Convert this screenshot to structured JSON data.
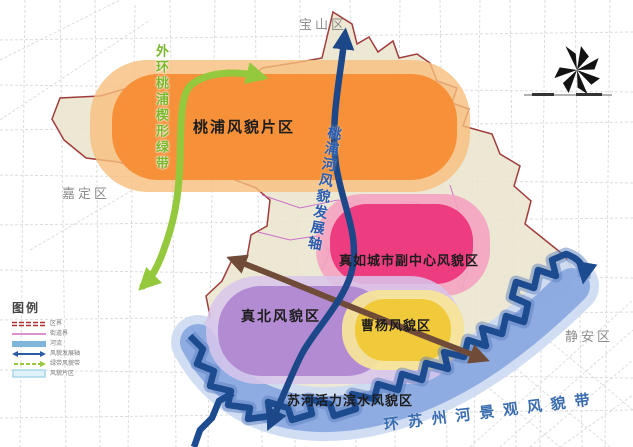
{
  "map": {
    "region_labels": {
      "baoshan": "宝山区",
      "jiading": "嘉定区",
      "jingan": "静安区"
    },
    "zones": {
      "taopu": {
        "label": "桃浦风貌片区",
        "color": "#F6913A",
        "halo": "#F7BE7C"
      },
      "zhenru": {
        "label": "真如城市副中心风貌区",
        "color": "#EE3C80",
        "halo": "#F3A3C0"
      },
      "zhenbei": {
        "label": "真北风貌区",
        "color": "#B28BD3",
        "halo": "#D8C6EB"
      },
      "caoyang": {
        "label": "曹杨风貌区",
        "color": "#F1CA3C",
        "halo": "#F6E49A"
      },
      "suhe": {
        "label": "苏河活力滨水风貌区",
        "color": "#8AA9DF",
        "halo": "#CBD9F1"
      }
    },
    "axes": {
      "green_belt": {
        "label": "外环桃浦楔形绿带",
        "color": "#8DC63F"
      },
      "taopu_river": {
        "label": "桃浦河风貌发展轴",
        "color": "#1C4889"
      },
      "suzhou_creek": {
        "label": "环苏州河景观风貌带",
        "color": "#3A6CB0"
      },
      "brown_axis": {
        "color": "#6F4B38"
      }
    },
    "legend": {
      "title": "图例",
      "items": [
        {
          "label": "区界"
        },
        {
          "label": "街道界"
        },
        {
          "label": "河流"
        },
        {
          "label": "风貌发展轴"
        },
        {
          "label": "绿带风貌带"
        },
        {
          "label": "风貌片区"
        }
      ]
    }
  }
}
